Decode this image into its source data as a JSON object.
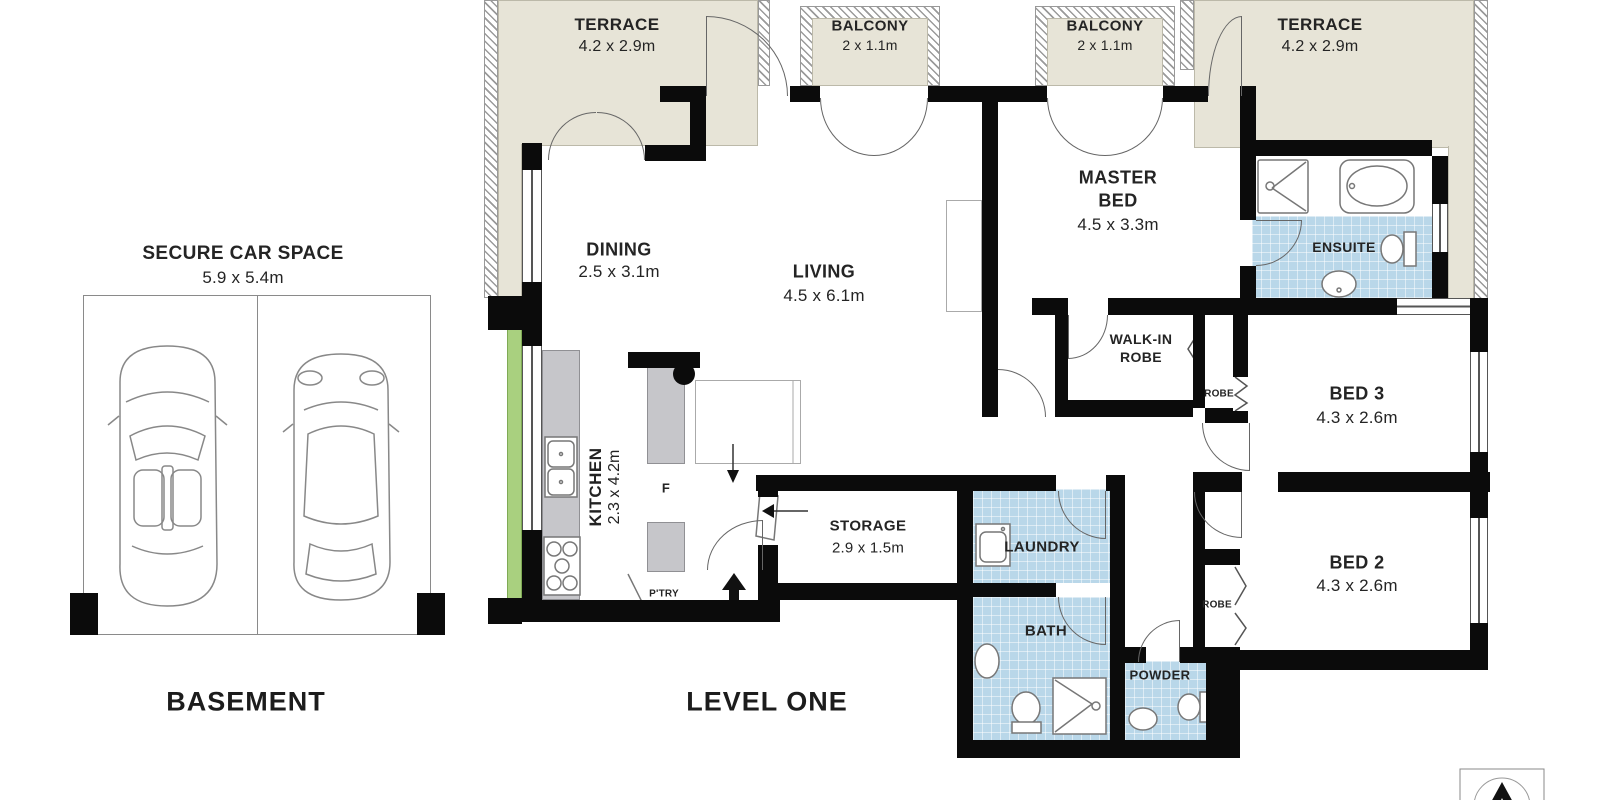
{
  "basement": {
    "title": "SECURE CAR SPACE",
    "dims": "5.9 x 5.4m",
    "caption": "BASEMENT"
  },
  "level_one": {
    "caption": "LEVEL ONE",
    "outdoor": {
      "terrace_left": {
        "label": "TERRACE",
        "dims": "4.2 x 2.9m"
      },
      "balcony_left": {
        "label": "BALCONY",
        "dims": "2 x 1.1m"
      },
      "balcony_right": {
        "label": "BALCONY",
        "dims": "2 x 1.1m"
      },
      "terrace_right": {
        "label": "TERRACE",
        "dims": "4.2 x 2.9m"
      }
    },
    "rooms": {
      "dining": {
        "label": "DINING",
        "dims": "2.5 x 3.1m"
      },
      "living": {
        "label": "LIVING",
        "dims": "4.5 x 6.1m"
      },
      "kitchen": {
        "label": "KITCHEN",
        "dims": "2.3 x 4.2m"
      },
      "fridge": {
        "label": "F"
      },
      "pantry": {
        "label": "P'TRY"
      },
      "master_bed": {
        "label1": "MASTER",
        "label2": "BED",
        "dims": "4.5 x 3.3m"
      },
      "ensuite": {
        "label": "ENSUITE"
      },
      "walk_in_robe": {
        "label1": "WALK-IN",
        "label2": "ROBE"
      },
      "robe_1": {
        "label": "ROBE"
      },
      "robe_2": {
        "label": "ROBE"
      },
      "bed_3": {
        "label": "BED 3",
        "dims": "4.3 x 2.6m"
      },
      "bed_2": {
        "label": "BED 2",
        "dims": "4.3 x 2.6m"
      },
      "storage": {
        "label": "STORAGE",
        "dims": "2.9 x 1.5m"
      },
      "laundry": {
        "label": "LAUNDRY"
      },
      "bath": {
        "label": "BATH"
      },
      "powder": {
        "label": "POWDER"
      }
    }
  },
  "colors": {
    "outdoor_floor": "#e7e4d7",
    "wet_floor": "#b9d7e9",
    "planter": "#a9d07f",
    "bench": "#c6c6ca",
    "wall": "#0b0b0b"
  }
}
